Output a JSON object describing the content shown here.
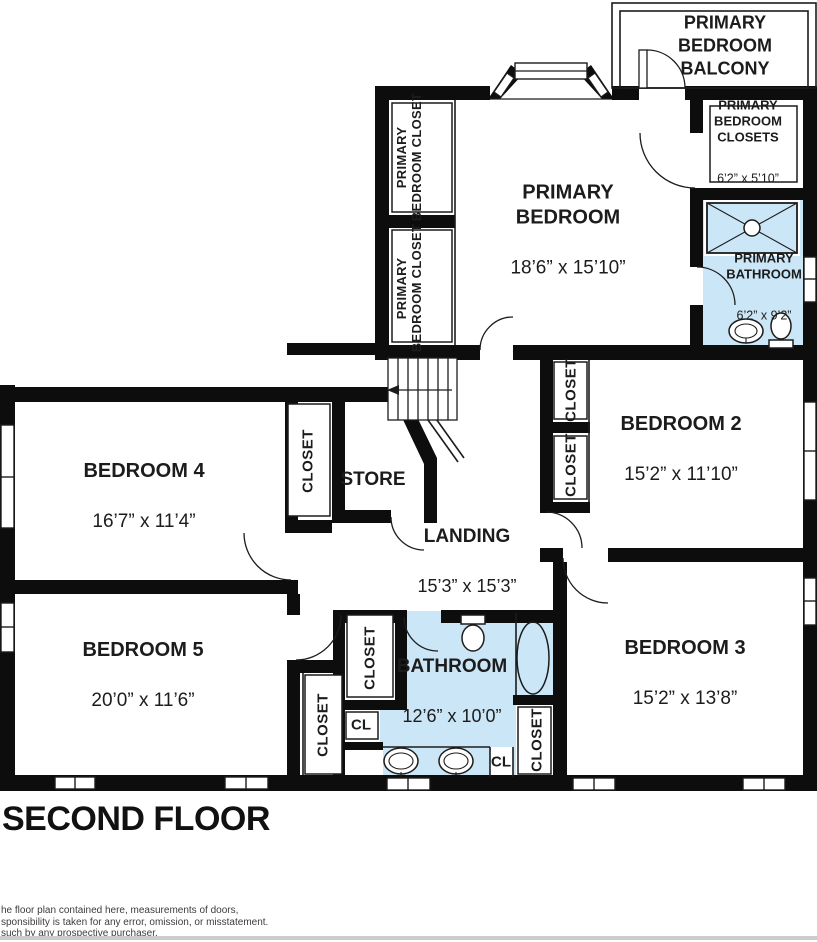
{
  "title": "SECOND FLOOR",
  "disclaimer": {
    "line1": "he floor plan contained here, measurements of doors,",
    "line2": "sponsibility is taken for any error, omission, or misstatement.",
    "line3": "such by any prospective purchaser."
  },
  "colors": {
    "wall": "#0d0d0d",
    "water": "#cbe6f6",
    "line": "#1c1c1c"
  },
  "labels": {
    "closet": "CLOSET",
    "cl": "CL"
  },
  "rooms": {
    "balcony": {
      "name": "PRIMARY\nBEDROOM\nBALCONY"
    },
    "primary_bedroom": {
      "name": "PRIMARY\nBEDROOM",
      "dims": "18’6” x 15’10”"
    },
    "primary_closets_room": {
      "name": "PRIMARY\nBEDROOM\nCLOSETS",
      "dims": "6’2” x 5’10”"
    },
    "primary_bathroom": {
      "name": "PRIMARY\nBATHROOM",
      "dims": "6’2” x 9’2”"
    },
    "primary_closet_upper": {
      "name": "PRIMARY\nBEDROOM CLOSET"
    },
    "primary_closet_lower": {
      "name": "PRIMARY\nBEDROOM CLOSET"
    },
    "bedroom2": {
      "name": "BEDROOM 2",
      "dims": "15’2” x 11’10”"
    },
    "bedroom3": {
      "name": "BEDROOM 3",
      "dims": "15’2” x 13’8”"
    },
    "bedroom4": {
      "name": "BEDROOM 4",
      "dims": "16’7” x 11’4”"
    },
    "bedroom5": {
      "name": "BEDROOM 5",
      "dims": "20’0” x 11’6”"
    },
    "landing": {
      "name": "LANDING",
      "dims": "15’3” x 15’3”"
    },
    "store": {
      "name": "STORE"
    },
    "bathroom": {
      "name": "BATHROOM",
      "dims": "12’6” x 10’0”"
    }
  }
}
